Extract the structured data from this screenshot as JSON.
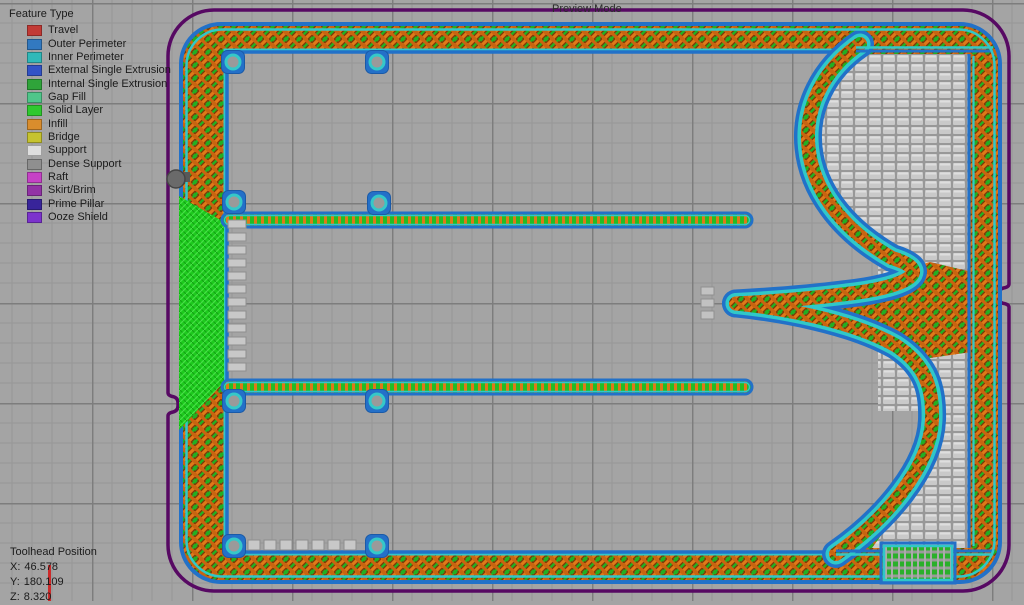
{
  "preview_mode_label": "Preview Mode",
  "legend": {
    "title": "Feature Type",
    "items": [
      {
        "label": "Travel",
        "color": "#c23a35"
      },
      {
        "label": "Outer Perimeter",
        "color": "#3279c0"
      },
      {
        "label": "Inner Perimeter",
        "color": "#30b9b9"
      },
      {
        "label": "External Single Extrusion",
        "color": "#3253c6"
      },
      {
        "label": "Internal Single Extrusion",
        "color": "#2fa43a"
      },
      {
        "label": "Gap Fill",
        "color": "#4fc68a"
      },
      {
        "label": "Solid Layer",
        "color": "#2fc92f"
      },
      {
        "label": "Infill",
        "color": "#d98d2d"
      },
      {
        "label": "Bridge",
        "color": "#c6c32f"
      },
      {
        "label": "Support",
        "color": "#dedede"
      },
      {
        "label": "Dense Support",
        "color": "#8f8f8f"
      },
      {
        "label": "Raft",
        "color": "#c642c6"
      },
      {
        "label": "Skirt/Brim",
        "color": "#9233a5"
      },
      {
        "label": "Prime Pillar",
        "color": "#38249a"
      },
      {
        "label": "Ooze Shield",
        "color": "#7c33cd"
      }
    ]
  },
  "toolhead": {
    "title": "Toolhead Position",
    "x_label": "X:",
    "x": "46.578",
    "y_label": "Y:",
    "y": "180.109",
    "z_label": "Z:",
    "z": "8.320"
  },
  "colors": {
    "bed": "#a4a4a4",
    "skirt_line": "#570963",
    "outer_perimeter": "#2271c8",
    "inner_perimeter": "#30c8c8",
    "infill": "#e07818",
    "solid_layer": "#1fcc1f",
    "support": "#c9c9c9",
    "travel": "#cc2a2a",
    "toolhead_dot": "#6a6a6a"
  }
}
